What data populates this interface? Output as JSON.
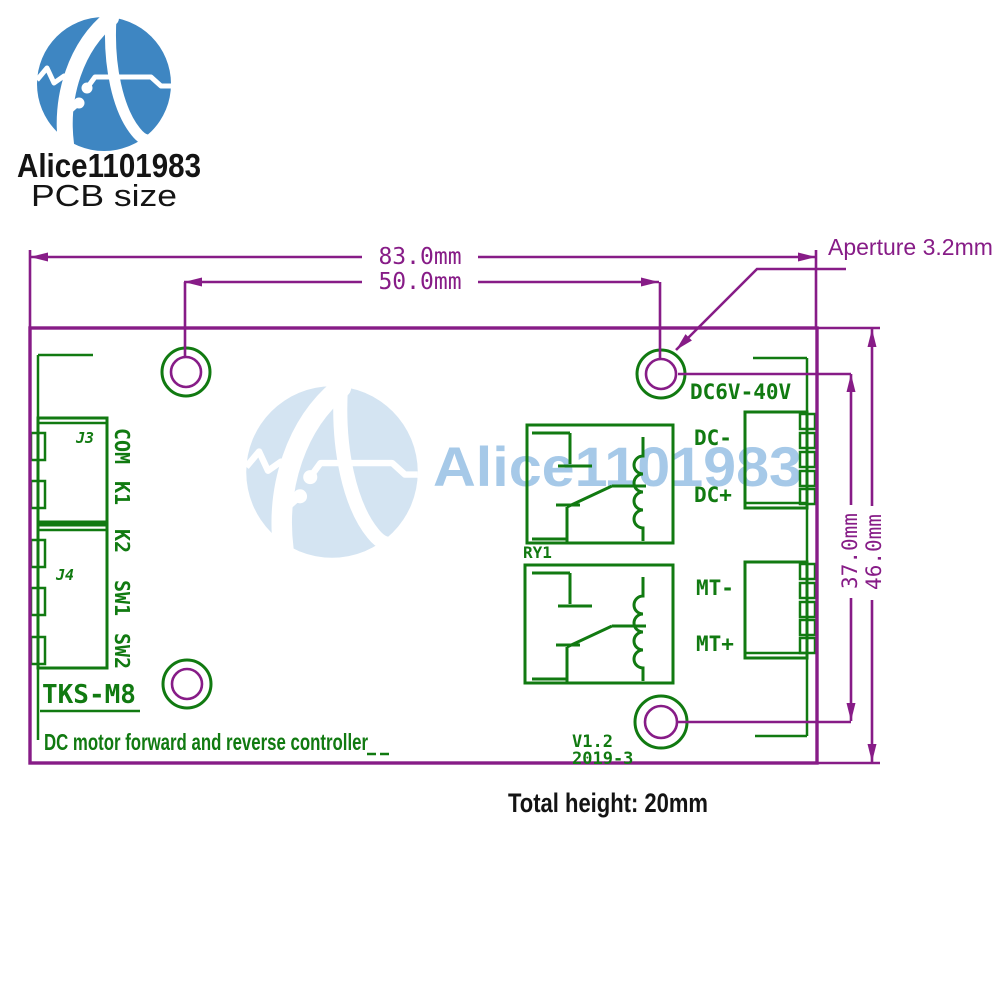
{
  "brand": {
    "name": "Alice1101983",
    "tagline": "PCB size"
  },
  "watermark": {
    "text": "Alice1101983"
  },
  "dimensions": {
    "board_width": "83.0mm",
    "hole_spacing_x": "50.0mm",
    "aperture": "Aperture 3.2mm",
    "hole_spacing_y": "37.0mm",
    "board_height": "46.0mm",
    "total_height": "Total height: 20mm"
  },
  "board": {
    "power_rating": "DC6V-40V",
    "terminals": {
      "dc_minus": "DC-",
      "dc_plus": "DC+",
      "mt_minus": "MT-",
      "mt_plus": "MT+"
    },
    "relay": "RY1",
    "connector_j3": "J3",
    "connector_j4": "J4",
    "pins": [
      "COM",
      "K1",
      "K2",
      "SW1",
      "SW2"
    ],
    "model": "TKS-M8",
    "description": "DC motor forward and reverse controller",
    "version": "V1.2",
    "date": "2019-3"
  },
  "colors": {
    "line_purple": "#871c87",
    "line_green": "#117a11",
    "logo_blue": "#3e86c2",
    "watermark_circle": "#d4e4f2",
    "watermark_text": "#a6c9e8",
    "ink": "#141414"
  }
}
